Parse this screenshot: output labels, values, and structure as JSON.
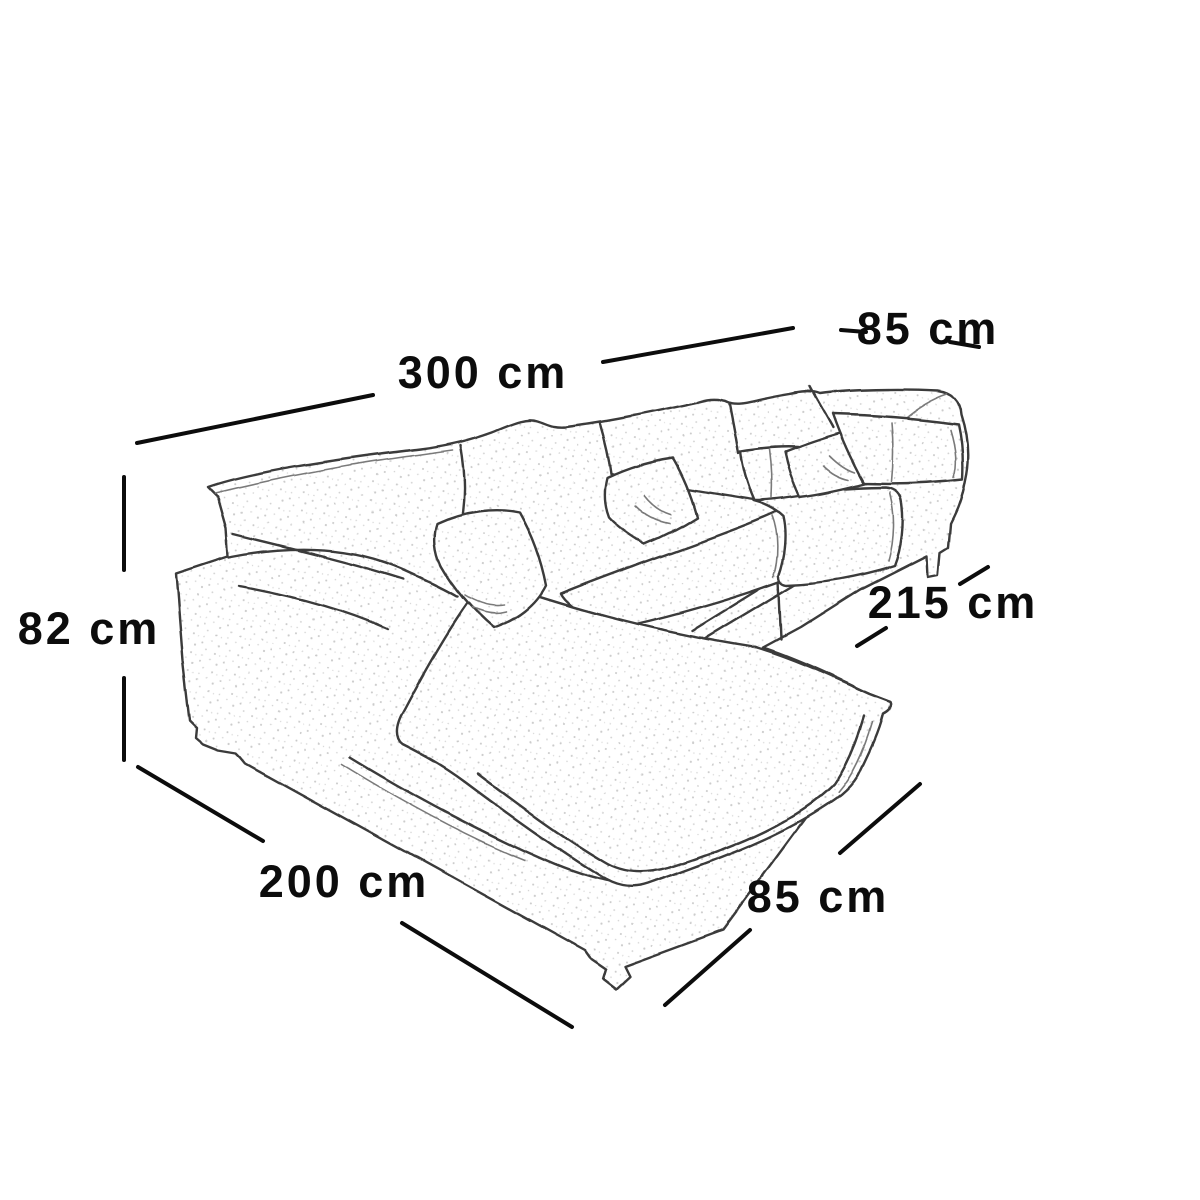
{
  "labels": {
    "back_width": "300 cm",
    "right_arm_depth": "85 cm",
    "seat_height": "82 cm",
    "right_side_length": "215 cm",
    "chaise_side_length": "200 cm",
    "front_depth": "85 cm"
  },
  "colors": {
    "ink": "#0c0c0c",
    "sketch_line": "#3a3a3a",
    "background": "#ffffff",
    "speckle": "#c9c9c9"
  }
}
